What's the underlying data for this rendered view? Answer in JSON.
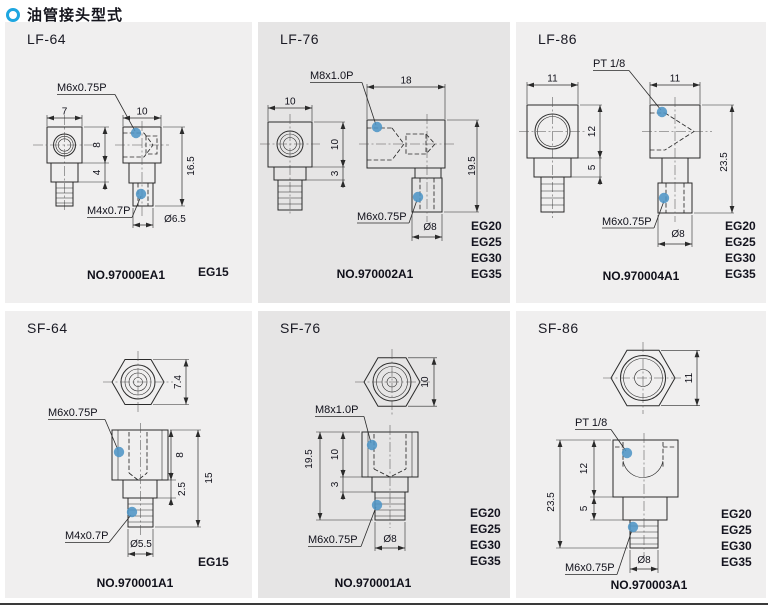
{
  "page": {
    "title": "油管接头型式",
    "bullet_icon": "ring-circle-icon",
    "colors": {
      "accent_cyan": "#1ea6e0",
      "thread_marker_blue": "#4e95c6",
      "panel_light": "#f0efef",
      "panel_dark": "#e6e5e5",
      "line": "#2a2a2a"
    }
  },
  "panels": [
    {
      "title": "LF-64",
      "part_no": "NO.97000EA1",
      "eg_sizes": [
        "EG15"
      ],
      "thread_label_top": "M6x0.75P",
      "thread_label_bottom": "M4x0.7P",
      "dims": {
        "front_width": "7",
        "side_width": "10",
        "body_height": "8",
        "step_height": "4",
        "total_height": "16.5",
        "stud_dia": "Ø6.5"
      }
    },
    {
      "title": "LF-76",
      "part_no": "NO.970002A1",
      "eg_sizes": [
        "EG20",
        "EG25",
        "EG30",
        "EG35"
      ],
      "thread_label_top": "M8x1.0P",
      "thread_label_bottom": "M6x0.75P",
      "dims": {
        "front_width": "10",
        "side_width": "18",
        "body_height": "10",
        "step_height": "3",
        "total_height": "19.5",
        "stud_dia": "Ø8"
      }
    },
    {
      "title": "LF-86",
      "part_no": "NO.970004A1",
      "eg_sizes": [
        "EG20",
        "EG25",
        "EG30",
        "EG35"
      ],
      "thread_label_top": "PT 1/8",
      "thread_label_bottom": "M6x0.75P",
      "dims": {
        "front_width": "11",
        "side_width": "11",
        "body_height": "12",
        "step_height": "5",
        "total_height": "23.5",
        "stud_dia": "Ø8"
      }
    },
    {
      "title": "SF-64",
      "part_no": "NO.970001A1",
      "eg_sizes": [
        "EG15"
      ],
      "thread_label_top": "M6x0.75P",
      "thread_label_bottom": "M4x0.7P",
      "dims": {
        "top_size": "7.4",
        "body_height": "8",
        "step_height": "2.5",
        "total_height": "15",
        "stud_dia": "Ø5.5"
      }
    },
    {
      "title": "SF-76",
      "part_no": "NO.970001A1",
      "eg_sizes": [
        "EG20",
        "EG25",
        "EG30",
        "EG35"
      ],
      "thread_label_top": "M8x1.0P",
      "thread_label_bottom": "M6x0.75P",
      "dims": {
        "top_size": "10",
        "body_height": "10",
        "step_height": "3",
        "total_height": "19.5",
        "stud_dia": "Ø8"
      }
    },
    {
      "title": "SF-86",
      "part_no": "NO.970003A1",
      "eg_sizes": [
        "EG20",
        "EG25",
        "EG30",
        "EG35"
      ],
      "thread_label_top": "PT 1/8",
      "thread_label_bottom": "M6x0.75P",
      "dims": {
        "top_size": "11",
        "body_height": "12",
        "step_height": "5",
        "total_height": "23.5",
        "stud_dia": "Ø8"
      }
    }
  ]
}
